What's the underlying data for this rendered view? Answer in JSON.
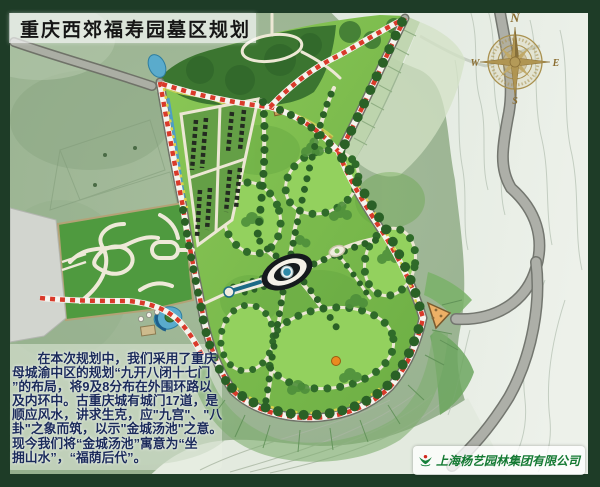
{
  "title": "重庆西郊福寿园墓区规划",
  "compass": {
    "north": "N",
    "south": "S",
    "east": "E",
    "west": "W"
  },
  "description": {
    "lines": [
      "　　在本次规划中，我们采用了重庆",
      "母城渝中区的规划“九开八闭十七门",
      "”的布局，将9及8分布在外围环路以",
      "及内环中。古重庆城有城门17道，是",
      "顺应风水，讲求生克，应\"九宫\"、\"八",
      "卦\"之象而筑，以示\"金城汤池\"之意。",
      "现今我们将“金城汤池”寓意为“坐",
      "拥山水”，“福荫后代”。"
    ]
  },
  "footer_logo": {
    "company_name": "上海杨艺园林集团有限公司"
  },
  "colors": {
    "frame_green": "#1e3c27",
    "title_text": "#161616",
    "description_text": "#1a2a5a",
    "boundary_red": "#d93a2a",
    "site_lawn": "#7ab949",
    "forest_green": "#3b7530",
    "road_gray": "#abaea4",
    "water_blue": "#5aabcc",
    "compass_gold": "#a9914f",
    "logo_green": "#157a33",
    "logo_red": "#d0281e"
  }
}
